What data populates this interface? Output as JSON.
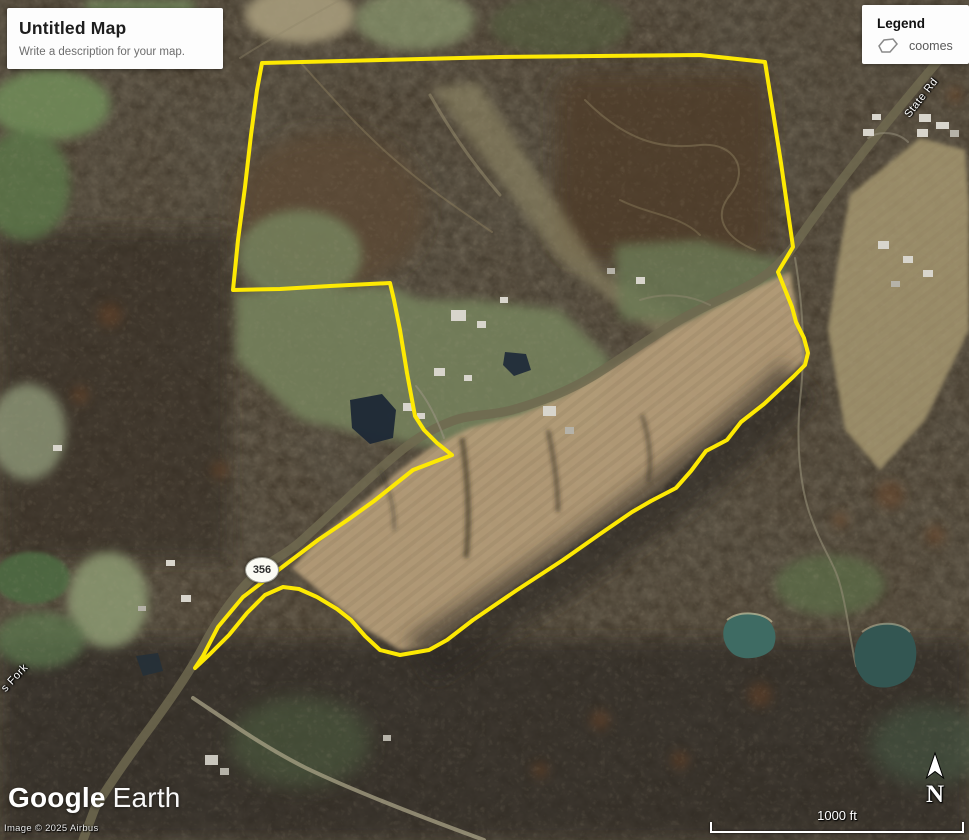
{
  "header": {
    "title": "Untitled Map",
    "description": "Write a description for your map."
  },
  "legend": {
    "title": "Legend",
    "items": [
      {
        "label": "coomes",
        "icon": "polygon-icon"
      }
    ]
  },
  "map_labels": {
    "route_shield": "356",
    "road_name": "State Rd",
    "stream_name": "s Fork"
  },
  "watermark": {
    "brand_google": "Google",
    "brand_earth": "Earth",
    "copyright": "Image © 2025 Airbus"
  },
  "scale_bar": {
    "label": "1000 ft"
  },
  "compass": {
    "label": "N"
  },
  "colors": {
    "boundary": "#fde903",
    "road": "#d5cd9e",
    "plowed_field": "#b49c78",
    "pasture": "#75815c",
    "forest": "#42382a",
    "pond_dark": "#1c2836",
    "pond_teal": "#3e6b63"
  },
  "boundary_polygon": {
    "name": "coomes",
    "stroke": "#fde903",
    "stroke_width": 4,
    "points": [
      [
        262,
        63
      ],
      [
        500,
        57
      ],
      [
        700,
        55
      ],
      [
        765,
        62
      ],
      [
        773,
        112
      ],
      [
        781,
        163
      ],
      [
        787,
        205
      ],
      [
        793,
        247
      ],
      [
        778,
        272
      ],
      [
        784,
        287
      ],
      [
        792,
        307
      ],
      [
        796,
        322
      ],
      [
        804,
        338
      ],
      [
        808,
        353
      ],
      [
        805,
        365
      ],
      [
        793,
        377
      ],
      [
        764,
        404
      ],
      [
        741,
        422
      ],
      [
        727,
        440
      ],
      [
        706,
        451
      ],
      [
        691,
        471
      ],
      [
        676,
        488
      ],
      [
        651,
        501
      ],
      [
        632,
        512
      ],
      [
        600,
        534
      ],
      [
        563,
        560
      ],
      [
        517,
        590
      ],
      [
        473,
        620
      ],
      [
        447,
        640
      ],
      [
        429,
        650
      ],
      [
        400,
        655
      ],
      [
        380,
        650
      ],
      [
        365,
        636
      ],
      [
        351,
        620
      ],
      [
        337,
        609
      ],
      [
        317,
        597
      ],
      [
        299,
        589
      ],
      [
        283,
        587
      ],
      [
        265,
        595
      ],
      [
        247,
        613
      ],
      [
        229,
        635
      ],
      [
        210,
        654
      ],
      [
        195,
        668
      ],
      [
        203,
        656
      ],
      [
        218,
        627
      ],
      [
        243,
        597
      ],
      [
        281,
        568
      ],
      [
        318,
        540
      ],
      [
        349,
        519
      ],
      [
        374,
        501
      ],
      [
        413,
        470
      ],
      [
        452,
        455
      ],
      [
        437,
        443
      ],
      [
        424,
        430
      ],
      [
        415,
        416
      ],
      [
        407,
        373
      ],
      [
        400,
        330
      ],
      [
        394,
        300
      ],
      [
        390,
        283
      ],
      [
        330,
        286
      ],
      [
        280,
        289
      ],
      [
        233,
        290
      ],
      [
        238,
        240
      ],
      [
        245,
        187
      ],
      [
        251,
        135
      ],
      [
        257,
        90
      ]
    ]
  }
}
